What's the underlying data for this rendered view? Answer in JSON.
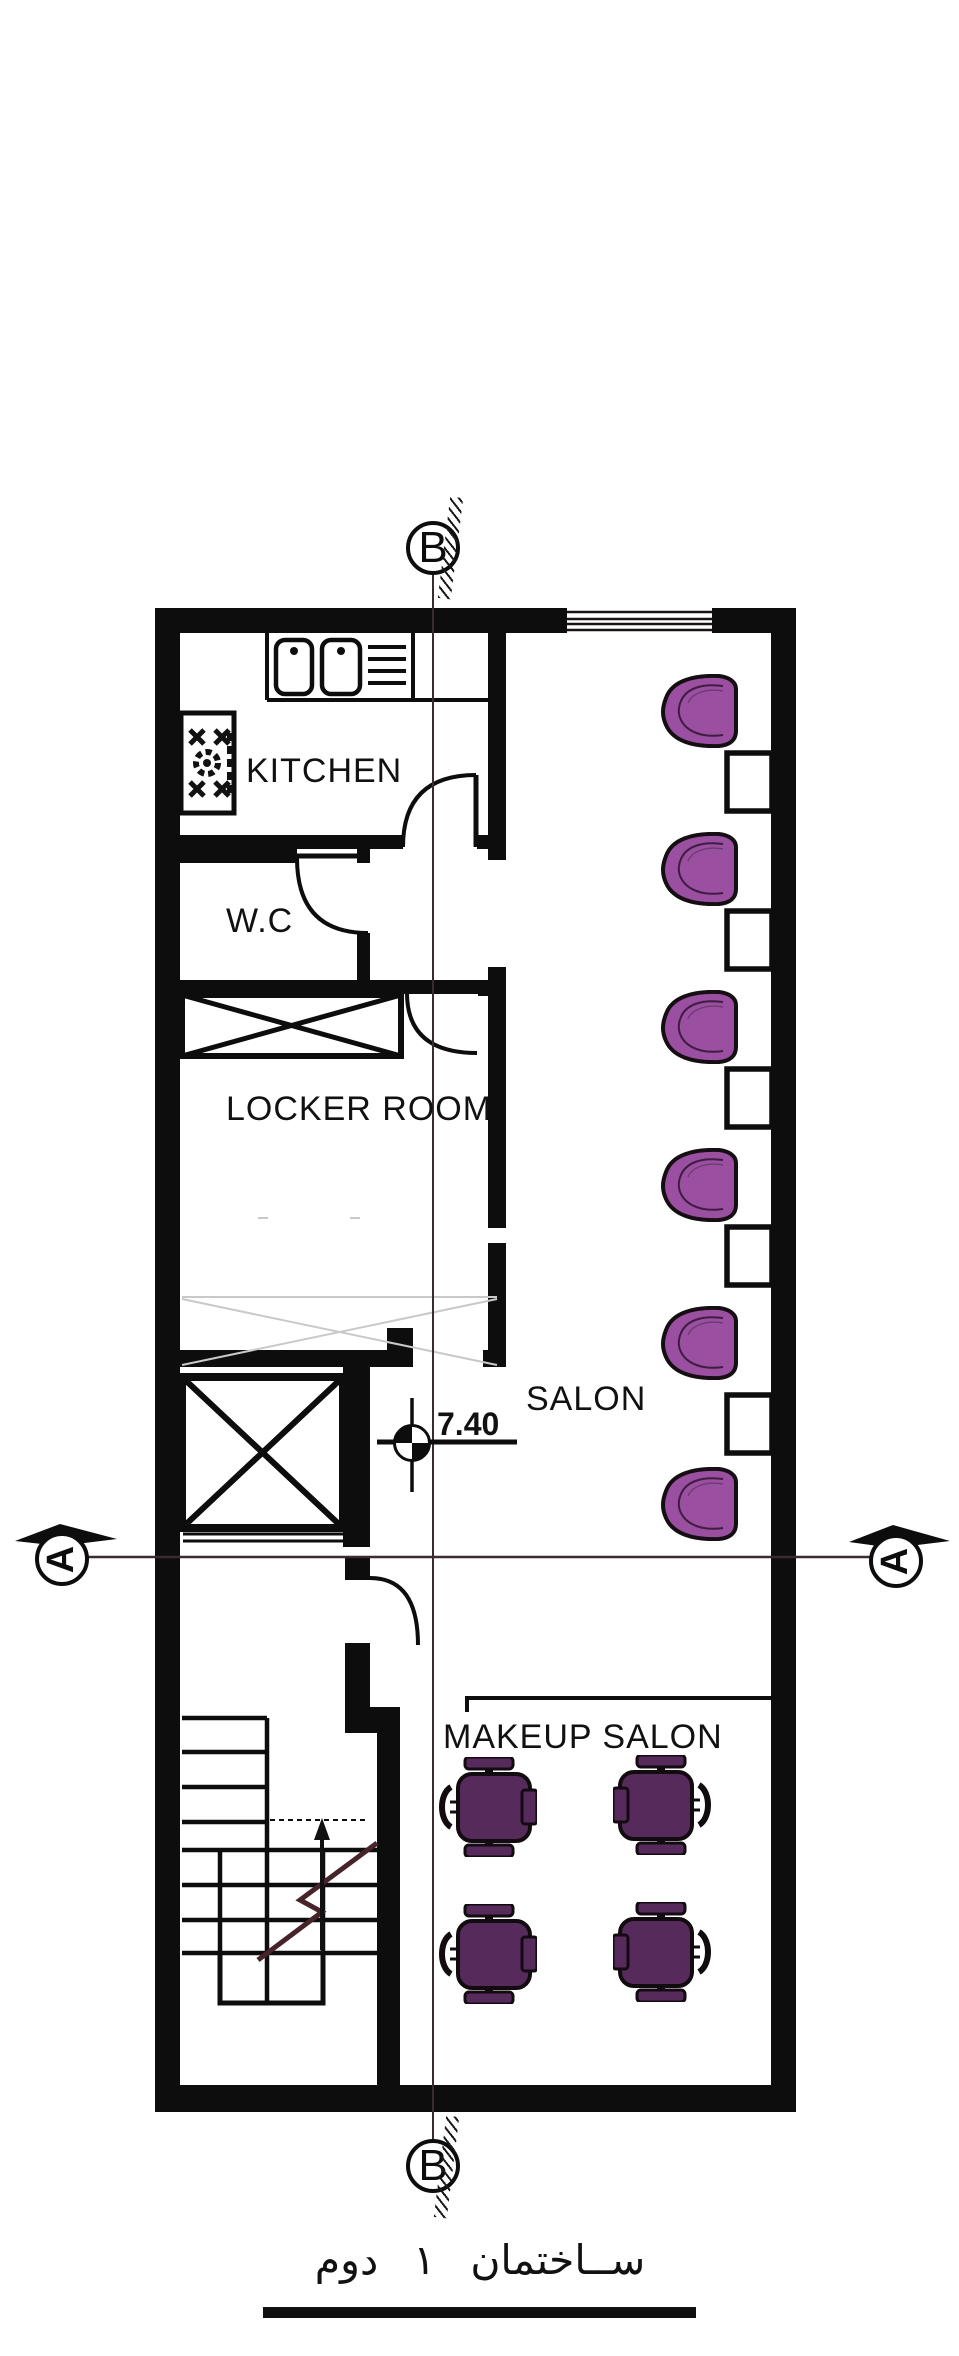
{
  "drawing": {
    "title_fa": "ســاختمان ۱    دوم",
    "rooms": {
      "kitchen": "KITCHEN",
      "wc": "W.C",
      "locker": "LOCKER ROOM",
      "salon": "SALON",
      "makeup": "MAKEUP SALON"
    },
    "level_value": "7.40",
    "section_markers": {
      "b": "B",
      "a": "A"
    },
    "furniture": {
      "salon_chairs_count": 6,
      "salon_side_tables_count": 5,
      "makeup_chairs_count": 4
    },
    "colors": {
      "salon_chair": "#9b4fa0",
      "salon_chair_outline": "#150e13",
      "makeup_chair": "#572a5c",
      "ink": "#0d0d0d",
      "section_line": "#3a2b30",
      "stair_break_line": "#47242a",
      "faint_line": "#c9c9c9"
    }
  }
}
